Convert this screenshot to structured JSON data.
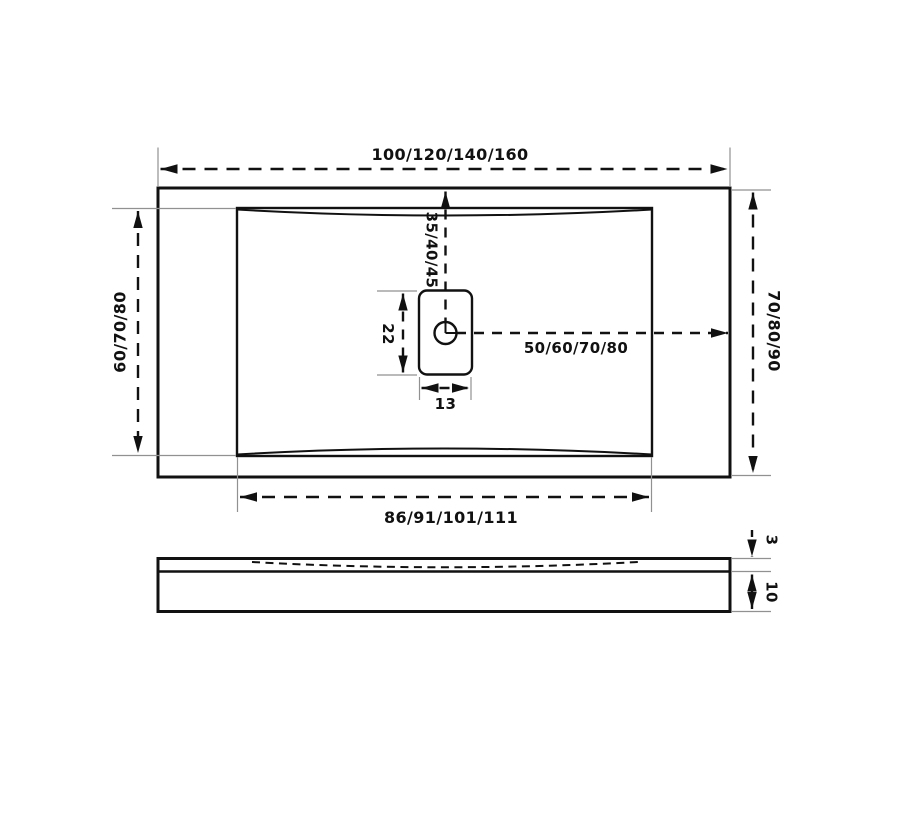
{
  "colors": {
    "line": "#111111",
    "extension_line": "#919191",
    "background": "#ffffff"
  },
  "top_view": {
    "overall_width_label": "100/120/140/160",
    "overall_depth_right_label": "70/80/90",
    "basin_depth_left_label": "60/70/80",
    "basin_width_bottom_label": "86/91/101/111",
    "drain": {
      "offset_from_top_label": "35/40/45",
      "offset_to_right_edge_label": "50/60/70/80",
      "cover_length_label": "22",
      "cover_width_label": "13"
    }
  },
  "side_view": {
    "rim_height_label": "3",
    "base_height_label": "10"
  }
}
